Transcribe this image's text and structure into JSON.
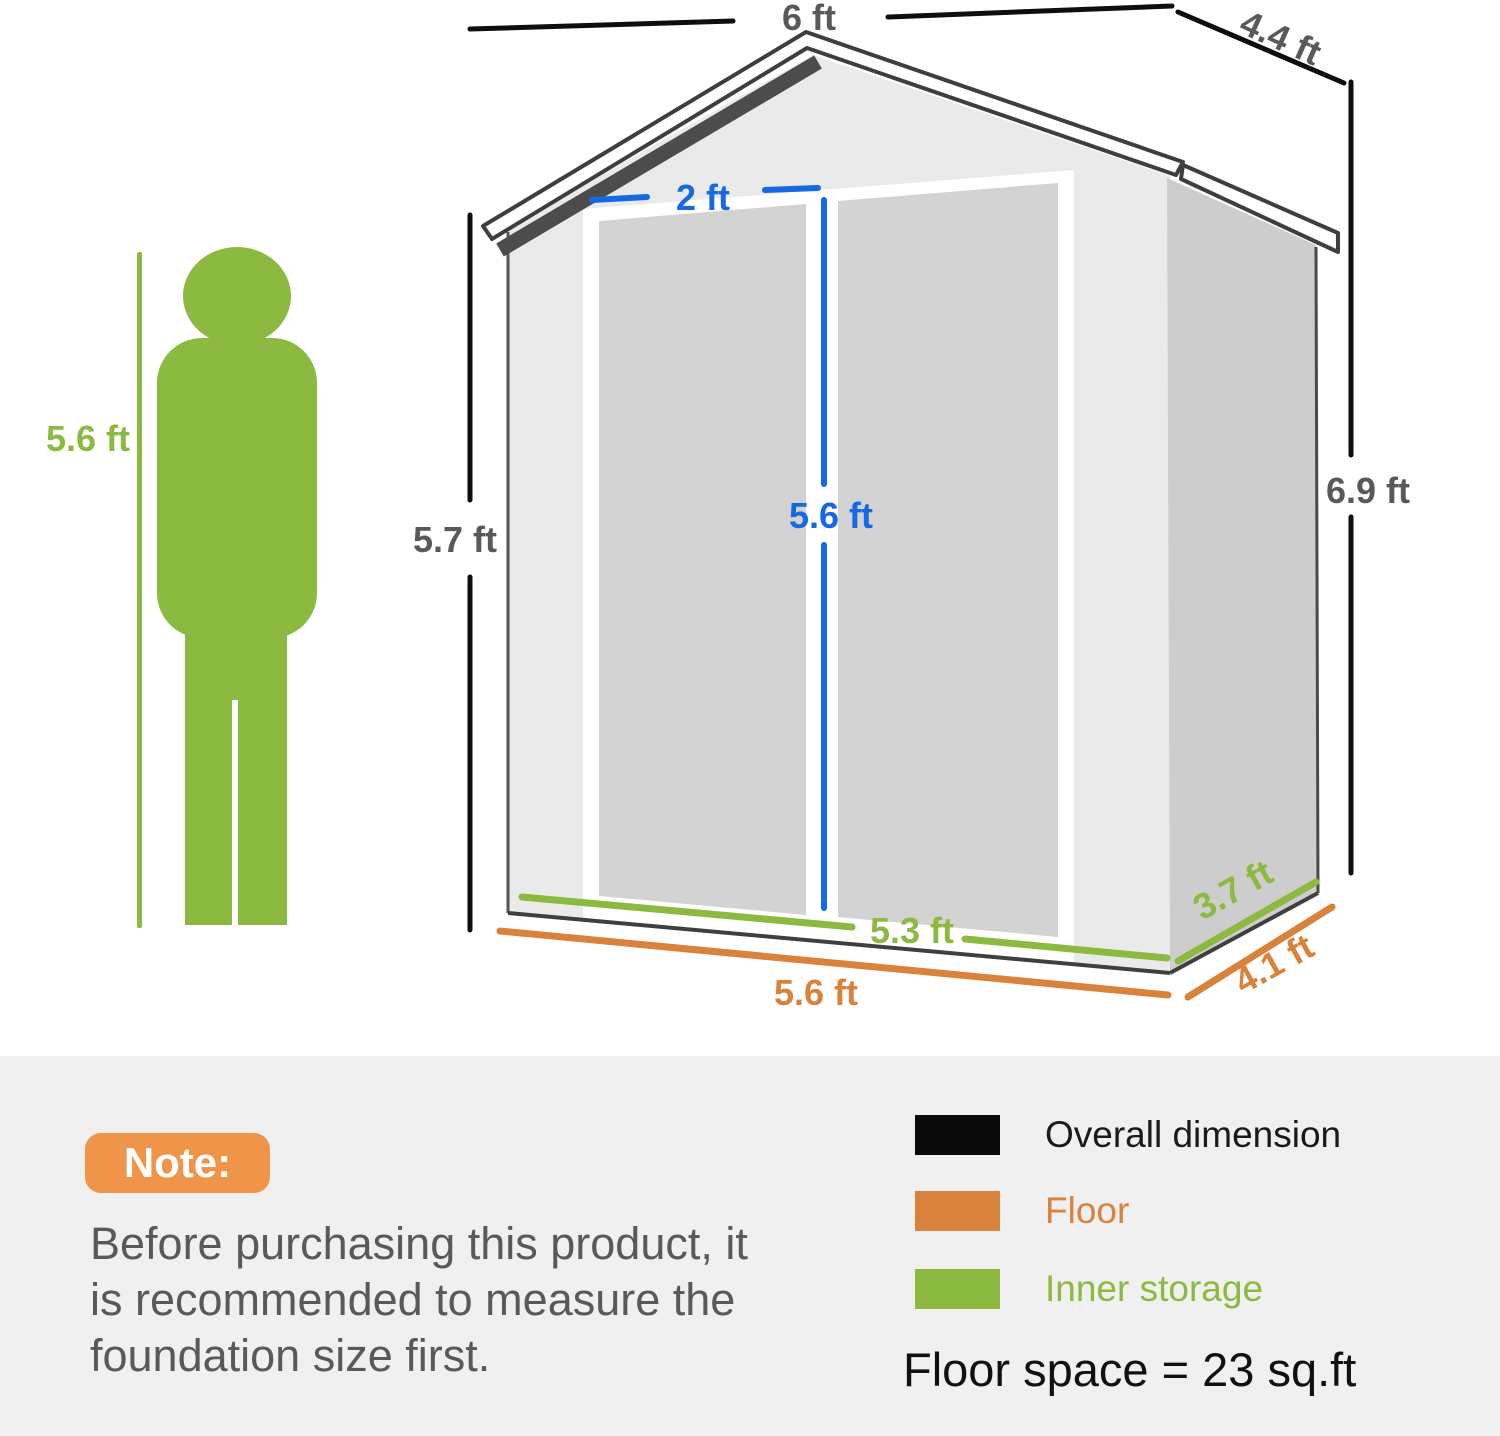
{
  "person": {
    "height": "5.6 ft"
  },
  "dimensions": {
    "overall_width": "6 ft",
    "overall_depth": "4.4 ft",
    "eave_height": "5.7 ft",
    "ridge_height": "6.9 ft",
    "door_width": "2 ft",
    "door_height": "5.6 ft",
    "inner_width": "5.3 ft",
    "inner_depth": "3.7 ft",
    "floor_width": "5.6 ft",
    "floor_depth": "4.1 ft"
  },
  "note": {
    "badge": "Note:",
    "body": "Before purchasing this product, it is recommended to measure the foundation size first."
  },
  "legend": {
    "overall": {
      "label": "Overall dimension",
      "color": "#0a0a0a"
    },
    "floor": {
      "label": "Floor",
      "color": "#d9823c"
    },
    "inner": {
      "label": "Inner storage",
      "color": "#8cb93f"
    },
    "floor_space": "Floor space = 23 sq.ft"
  },
  "colors": {
    "dimension_blue": "#1668e3",
    "inner_green": "#8cb93f",
    "floor_orange": "#d9823c",
    "label_gray": "#58595b",
    "note_badge_orange": "#f0944a"
  }
}
